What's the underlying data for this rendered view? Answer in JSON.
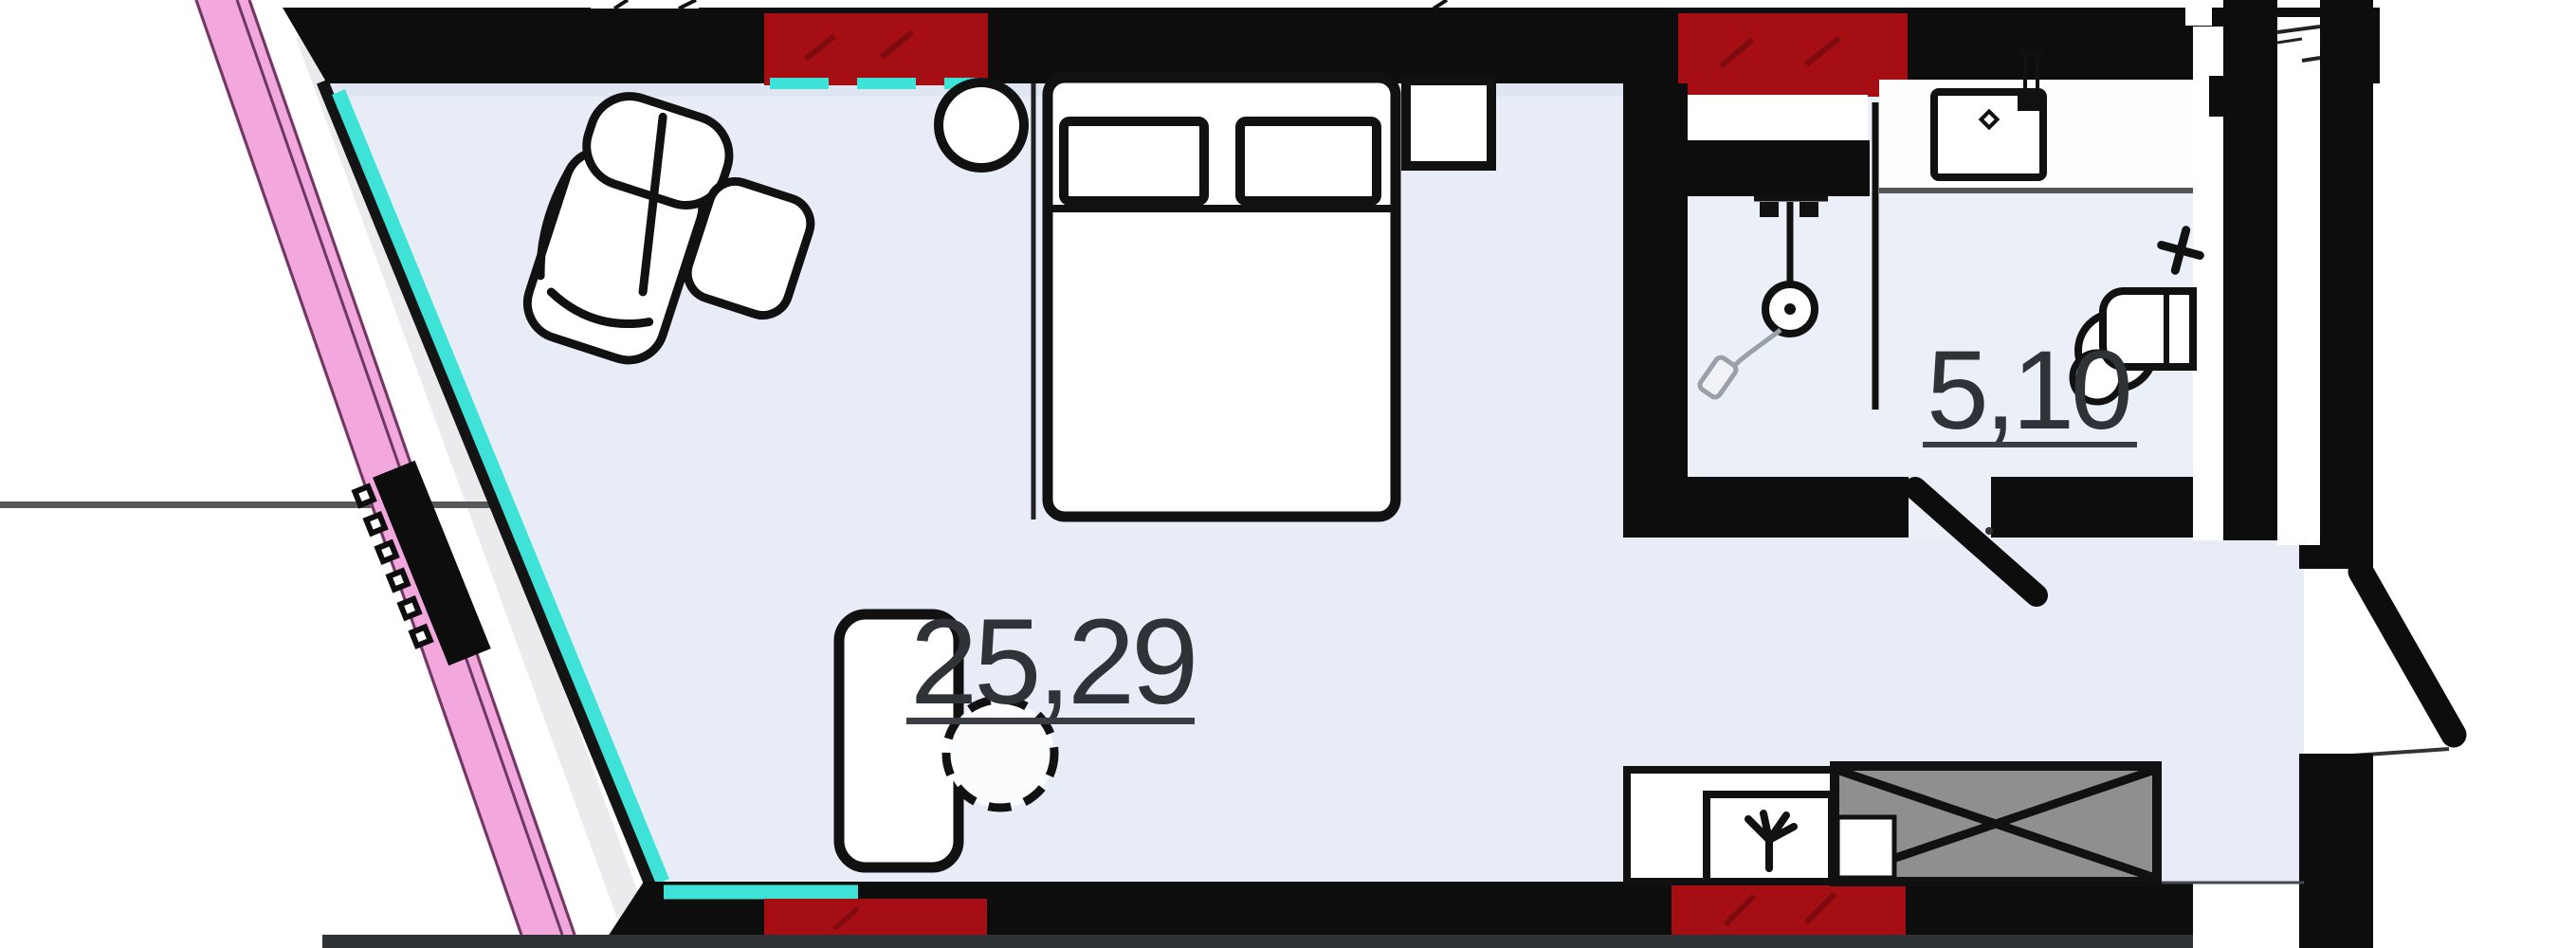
{
  "plan": {
    "title": "studio-apartment-floor-plan",
    "rooms": [
      {
        "id": "living-room",
        "area_label": "25,29"
      },
      {
        "id": "bathroom",
        "area_label": "5,10"
      }
    ],
    "colors": {
      "wall_black": "#0d0d0d",
      "wet_zone_red": "#a50f14",
      "window_cyan": "#3fe2d7",
      "facade_pink": "#f2a8dc",
      "floor_blue": "#e7ecf6",
      "label_text": "#2f3338",
      "dimension_gray": "#57585a",
      "sink_box_gray": "#8f8f8f",
      "bottom_bar": "#2f3335"
    },
    "furniture": [
      "armchair",
      "ottoman",
      "pendant-lamp",
      "double-bed",
      "pillow",
      "pillow",
      "nightstand",
      "desk",
      "desk-chair",
      "radiator",
      "kitchen-counter",
      "stove-burner",
      "kitchen-sink-box",
      "bathroom-counter",
      "washbasin",
      "faucet",
      "shower",
      "shower-hose",
      "toilet",
      "water-valve-cross",
      "bathroom-door",
      "balcony-door",
      "entry-door"
    ]
  }
}
